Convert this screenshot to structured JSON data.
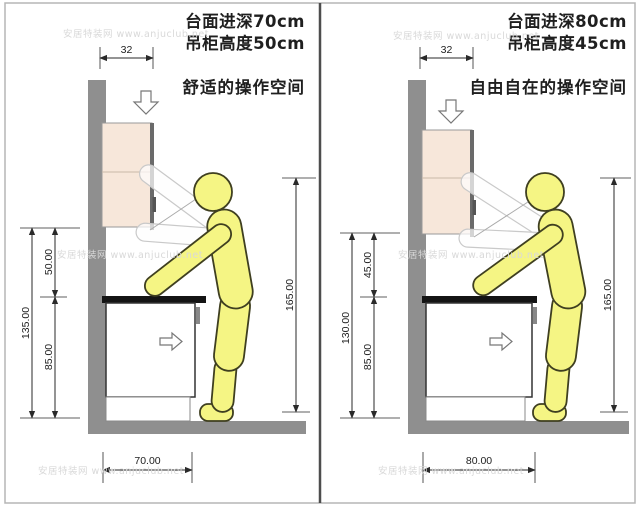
{
  "watermark": {
    "text": "安居特装网 www.anjuclub.net"
  },
  "panels": {
    "left": {
      "header": {
        "line1": "台面进深70cm",
        "line2": "吊柜高度50cm"
      },
      "caption": "舒适的操作空间",
      "dims": {
        "cabinet_depth_top": "32",
        "cabinet_to_counter": "50.00",
        "counter_to_floor": "85.00",
        "cabinet_to_floor": "135.00",
        "reach_height": "165.00",
        "counter_depth": "70.00"
      }
    },
    "right": {
      "header": {
        "line1": "台面进深80cm",
        "line2": "吊柜高度45cm"
      },
      "caption": "自由自在的操作空间",
      "dims": {
        "cabinet_depth_top": "32",
        "cabinet_to_counter": "45.00",
        "counter_to_floor": "85.00",
        "cabinet_to_floor": "130.00",
        "reach_height": "165.00",
        "counter_depth": "80.00"
      }
    }
  },
  "colors": {
    "wall": "#8f8f8f",
    "floor": "#8f8f8f",
    "cabinet_fill": "#f7e7da",
    "cabinet_edge": "#6a6a6a",
    "counter": "#141414",
    "figure_fill": "#f5f584",
    "dim": "#2a2a2a"
  }
}
